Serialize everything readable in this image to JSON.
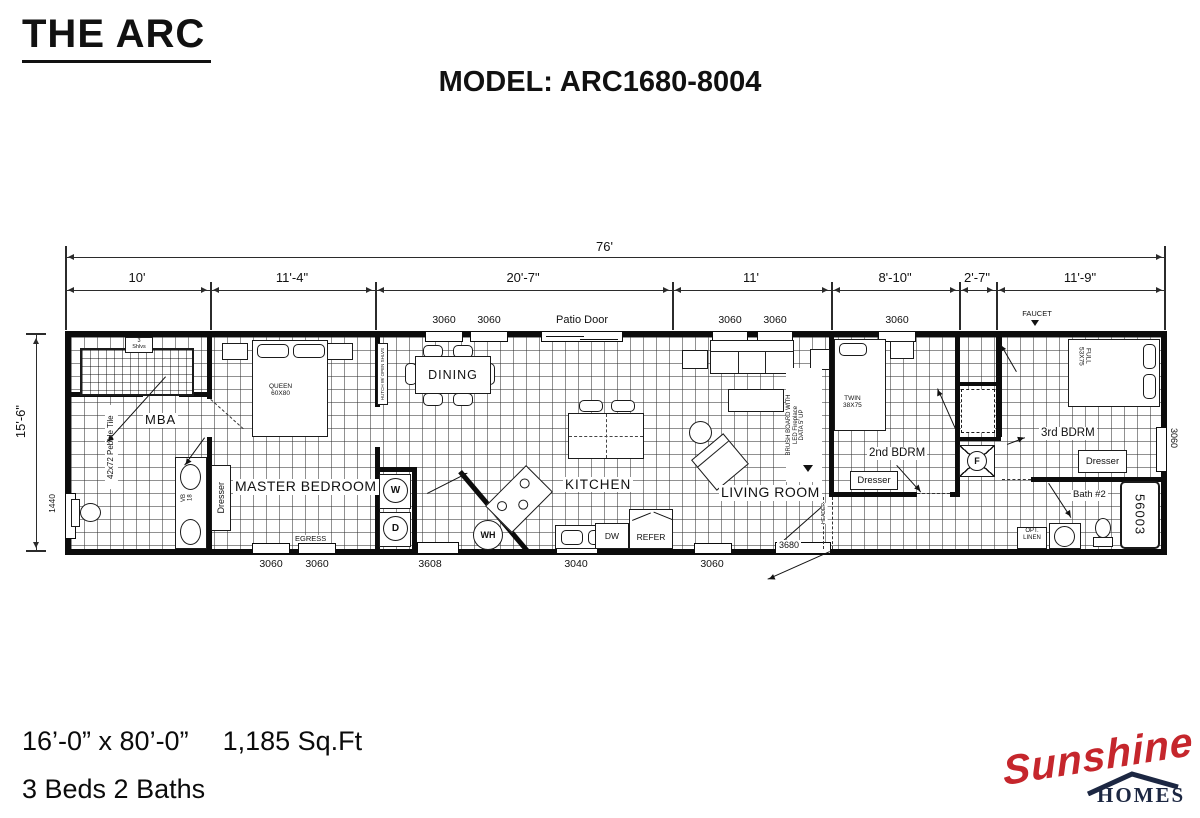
{
  "header": {
    "title": "THE ARC",
    "model": "MODEL: ARC1680-8004"
  },
  "dims": {
    "overall": "76'",
    "height": "15'-6\"",
    "segments": [
      "10'",
      "11'-4\"",
      "20'-7\"",
      "11'",
      "8'-10\"",
      "2'-7\"",
      "11'-9\""
    ]
  },
  "openings": {
    "top": [
      "3060",
      "3060",
      "Patio Door",
      "3060",
      "3060",
      "3060"
    ],
    "bottom": [
      "3060",
      "3060",
      "3608",
      "3040",
      "3060",
      "3680"
    ],
    "left": "1440",
    "right": "3060",
    "faucet": "FAUCET"
  },
  "rooms": {
    "mba": {
      "label": "MBA",
      "tile": "42x72 Pebble Tile",
      "shelves": "3\nShlvs",
      "vanity": "VB\n18"
    },
    "master": {
      "label": "MASTER BEDROOM",
      "bed": "QUEEN\n60X80",
      "dresser": "Dresser",
      "egress": "EGRESS"
    },
    "utility": {
      "washer": "W",
      "dryer": "D",
      "hutch": "HUTCH W/ OPEN SHLVS",
      "water_heater": "WH"
    },
    "dining": {
      "label": "DINING"
    },
    "kitchen": {
      "label": "KITCHEN",
      "dishwasher": "DW",
      "refrigerator": "REFER"
    },
    "living": {
      "label": "LIVING ROOM",
      "fireplace_note": "BRUSH BOARD WITH\nLED Fireplace\nDATA 5' UP",
      "header_note": "HEADER"
    },
    "bdrm2": {
      "label": "2nd BDRM",
      "bed": "TWIN\n38X75",
      "dresser": "Dresser"
    },
    "hall": {
      "furnace": "F"
    },
    "bdrm3": {
      "label": "3rd BDRM",
      "bed": "FULL\n53X75",
      "dresser": "Dresser"
    },
    "bath2": {
      "label": "Bath #2",
      "linen": "OPT.\nLINEN",
      "tub_model": "56003"
    }
  },
  "footer": {
    "size": "16’-0” x 80’-0”",
    "sqft": "1,185 Sq.Ft",
    "beds": "3 Beds 2 Baths"
  },
  "logo": {
    "name": "Sunshine",
    "sub": "HOMES"
  }
}
